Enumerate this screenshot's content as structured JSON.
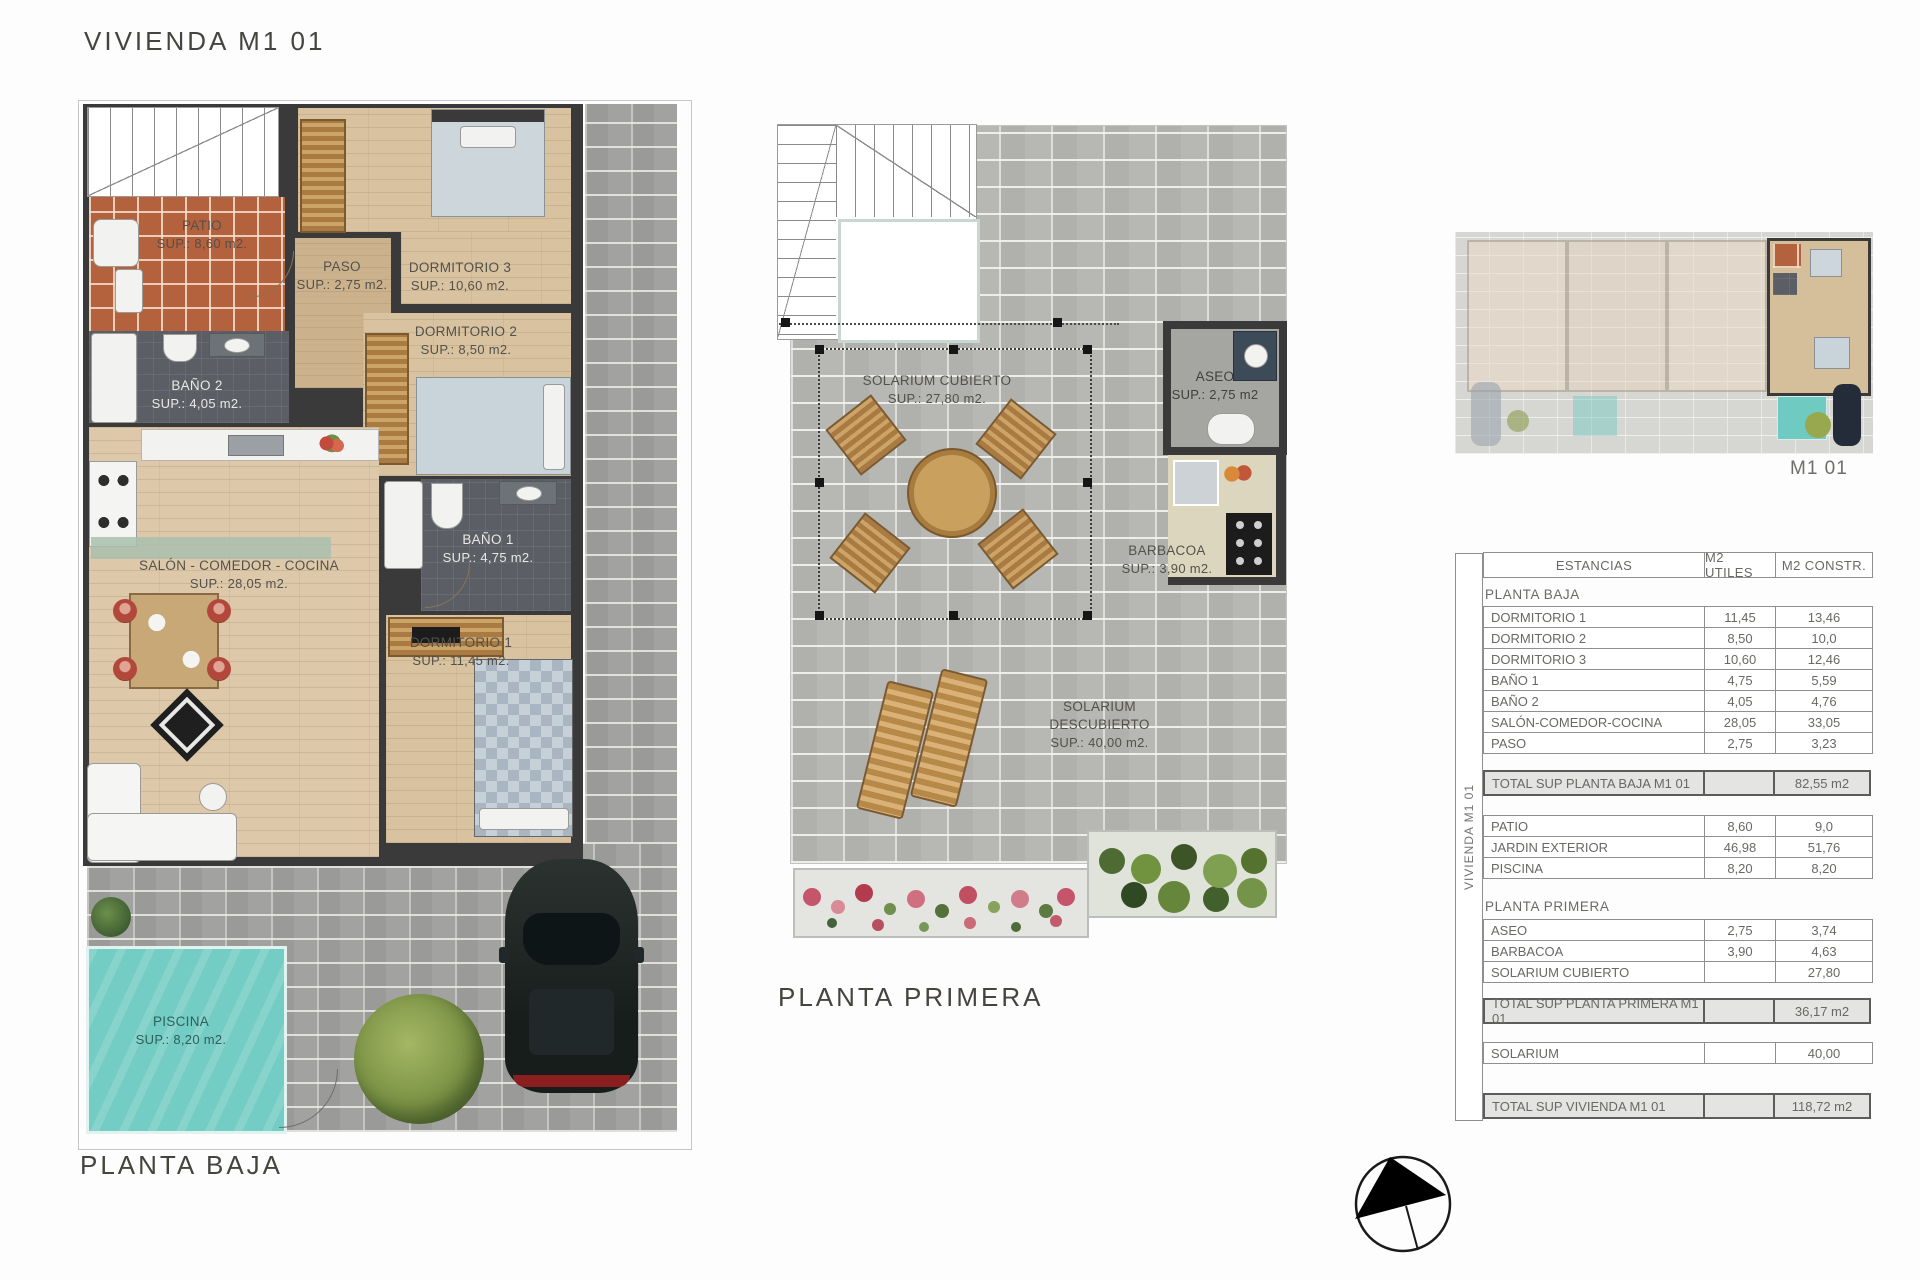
{
  "title": "VIVIENDA M1 01",
  "plans": {
    "baja": {
      "caption": "PLANTA BAJA",
      "rooms": {
        "patio": {
          "name": "PATIO",
          "area": "SUP.: 8,60 m2."
        },
        "paso": {
          "name": "PASO",
          "area": "SUP.: 2,75 m2."
        },
        "dormitorio3": {
          "name": "DORMITORIO 3",
          "area": "SUP.: 10,60 m2."
        },
        "dormitorio2": {
          "name": "DORMITORIO 2",
          "area": "SUP.: 8,50 m2."
        },
        "bano2": {
          "name": "BAÑO 2",
          "area": "SUP.: 4,05 m2."
        },
        "salon": {
          "name": "SALÓN - COMEDOR - COCINA",
          "area": "SUP.: 28,05 m2."
        },
        "bano1": {
          "name": "BAÑO 1",
          "area": "SUP.: 4,75 m2."
        },
        "dormitorio1": {
          "name": "DORMITORIO 1",
          "area": "SUP.: 11,45 m2."
        },
        "piscina": {
          "name": "PISCINA",
          "area": "SUP.: 8,20 m2."
        }
      }
    },
    "primera": {
      "caption": "PLANTA PRIMERA",
      "rooms": {
        "solarium_cubierto": {
          "name": "SOLARIUM CUBIERTO",
          "area": "SUP.: 27,80 m2."
        },
        "aseo": {
          "name": "ASEO",
          "area": "SUP.: 2,75 m2"
        },
        "barbacoa": {
          "name": "BARBACOA",
          "area": "SUP.: 3,90 m2."
        },
        "solarium_descubierto": {
          "name": "SOLARIUM DESCUBIERTO",
          "area": "SUP.: 40,00 m2."
        }
      }
    }
  },
  "site_thumbnail": {
    "caption": "M1 01"
  },
  "areas_table": {
    "side_label": "VIVIENDA M1 01",
    "headers": {
      "estancias": "ESTANCIAS",
      "utiles": "M2 UTILES",
      "constr": "M2 CONSTR."
    },
    "sections": {
      "baja": "PLANTA BAJA",
      "primera": "PLANTA PRIMERA"
    },
    "rows": [
      {
        "label": "DORMITORIO 1",
        "utiles": "11,45",
        "constr": "13,46"
      },
      {
        "label": "DORMITORIO 2",
        "utiles": "8,50",
        "constr": "10,0"
      },
      {
        "label": "DORMITORIO 3",
        "utiles": "10,60",
        "constr": "12,46"
      },
      {
        "label": "BAÑO 1",
        "utiles": "4,75",
        "constr": "5,59"
      },
      {
        "label": "BAÑO 2",
        "utiles": "4,05",
        "constr": "4,76"
      },
      {
        "label": "SALÓN-COMEDOR-COCINA",
        "utiles": "28,05",
        "constr": "33,05"
      },
      {
        "label": "PASO",
        "utiles": "2,75",
        "constr": "3,23"
      },
      {
        "label": "PATIO",
        "utiles": "8,60",
        "constr": "9,0"
      },
      {
        "label": "JARDIN EXTERIOR",
        "utiles": "46,98",
        "constr": "51,76"
      },
      {
        "label": "PISCINA",
        "utiles": "8,20",
        "constr": "8,20"
      },
      {
        "label": "ASEO",
        "utiles": "2,75",
        "constr": "3,74"
      },
      {
        "label": "BARBACOA",
        "utiles": "3,90",
        "constr": "4,63"
      },
      {
        "label": "SOLARIUM CUBIERTO",
        "utiles": "",
        "constr": "27,80"
      },
      {
        "label": "SOLARIUM",
        "utiles": "",
        "constr": "40,00"
      }
    ],
    "totals": [
      {
        "label": "TOTAL SUP PLANTA BAJA M1 01",
        "constr": "82,55 m2"
      },
      {
        "label": "TOTAL SUP PLANTA PRIMERA  M1 01",
        "constr": "36,17 m2"
      },
      {
        "label": "TOTAL SUP VIVIENDA  M1 01",
        "constr": "118,72 m2"
      }
    ]
  }
}
